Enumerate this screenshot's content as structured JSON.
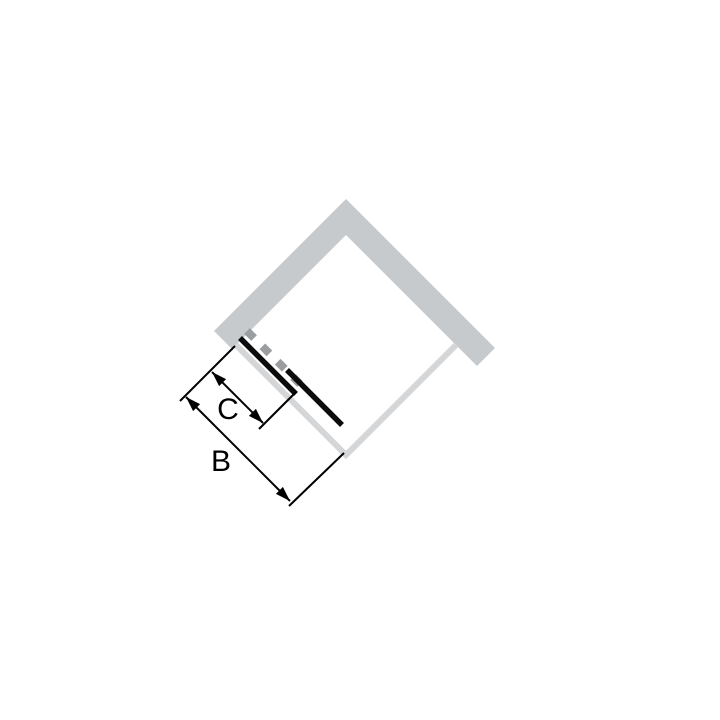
{
  "diagram": {
    "labels": {
      "dim_b": "B",
      "dim_c": "C"
    },
    "colors": {
      "bg": "#ffffff",
      "wall": "#c7cacc",
      "edge": "#d4d6d8",
      "dash": "#9a9ea1",
      "door": "#0c0c0c",
      "dim": "#000000"
    }
  }
}
